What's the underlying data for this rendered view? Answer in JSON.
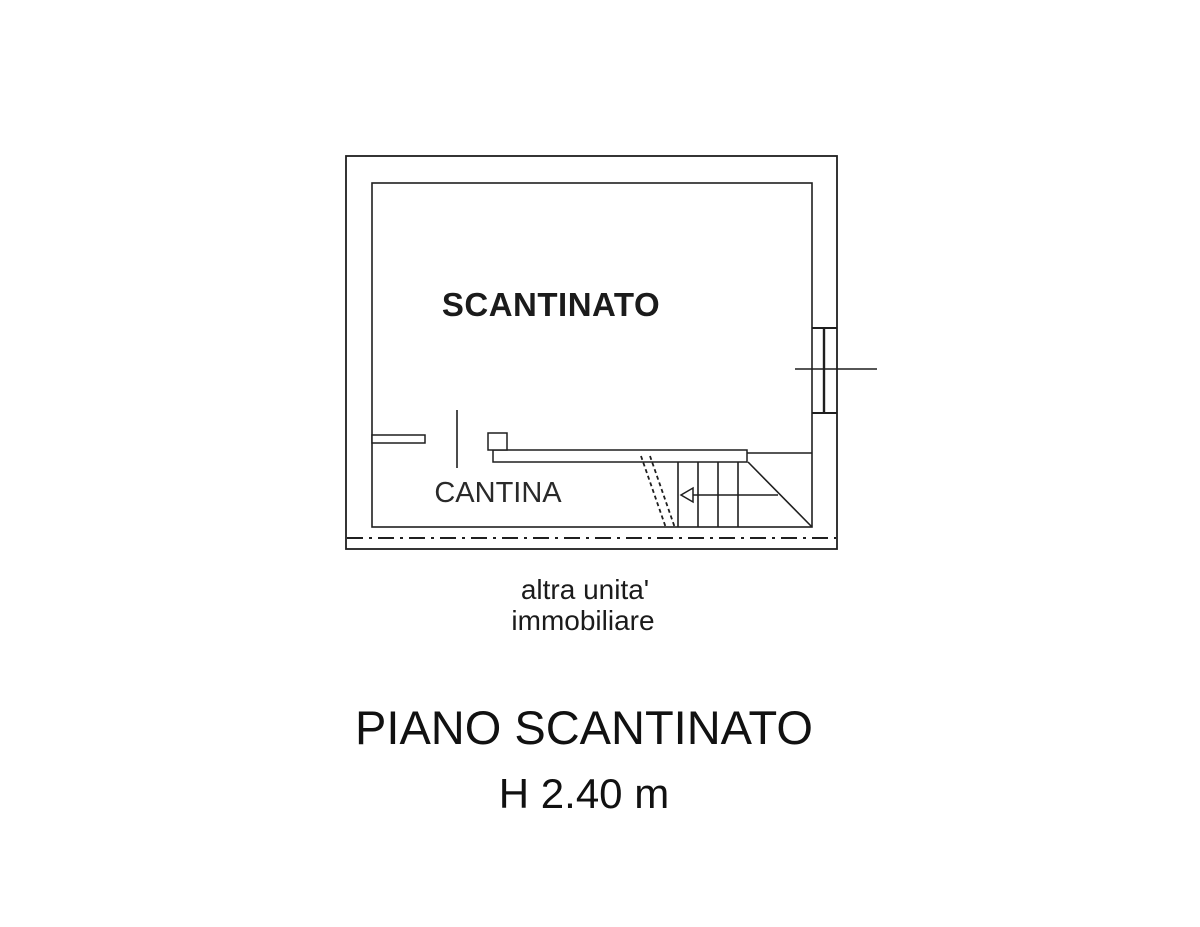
{
  "plan": {
    "rooms": [
      {
        "label": "SCANTINATO"
      },
      {
        "label": "CANTINA"
      }
    ],
    "boundary_note": {
      "line1": "altra unita'",
      "line2": "immobiliare"
    }
  },
  "caption": {
    "title": "PIANO SCANTINATO",
    "height_note": "H 2.40 m"
  },
  "colors": {
    "line": "#1f1f1f",
    "background": "#ffffff"
  }
}
